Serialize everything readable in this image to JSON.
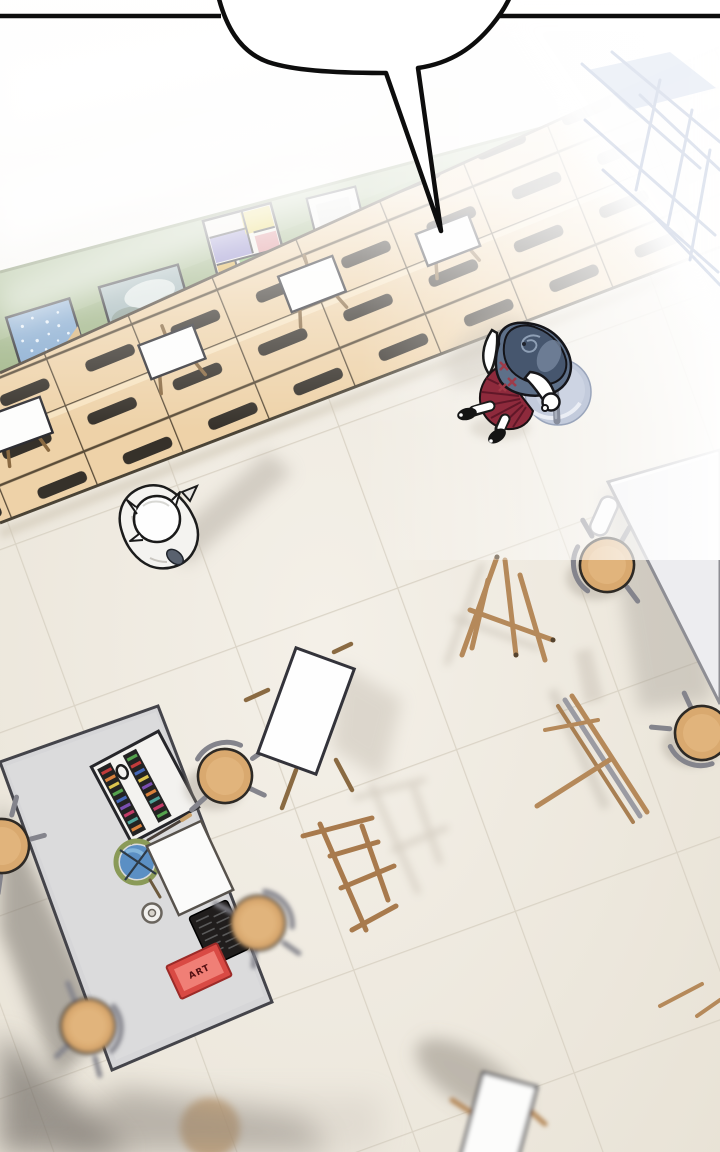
{
  "panel": {
    "type": "webtoon comic panel, overhead view of an art classroom",
    "speech_bubble": {
      "text": "",
      "shape": "white speech bubble cropped by top edge, long narrow tail pointing down toward a canvas on the shelves"
    },
    "sign": {
      "label": "ART"
    },
    "board": {
      "color": "#a6ba8e",
      "artworks": [
        "speckled-blue-painting",
        "blurry-landscape-painting",
        "abstract-color-block-painting",
        "blank-canvas"
      ]
    },
    "shelves": {
      "type": "wooden cubby drawer units with dark slots, white canvases leaning on top",
      "color": "#eed2a8"
    },
    "characters": [
      {
        "name": "student-dark-hair",
        "hair_color": "#46566e",
        "top_color": "#5e7089",
        "plaid_color": "#a23a47",
        "skirt_color": "#8e2a3c",
        "carrying": "round light-blue canvas bag"
      },
      {
        "name": "student-white-hair",
        "hair_color": "#fefefe",
        "outfit_color": "#f4f3f0"
      }
    ],
    "furniture": {
      "teacher_desk_items": [
        "paint-set-box",
        "paintbrush",
        "blue-round-palette",
        "paper-sheet",
        "tape-roll",
        "black-brush-case",
        "red-art-sign"
      ],
      "stool_count": 7,
      "easels": [
        "standing-easel-with-canvas",
        "fallen-folded-easel",
        "leaning-folded-easel",
        "bare-easel-frame",
        "bottom-easel-with-canvas"
      ],
      "tables": [
        "teacher-desk",
        "white-work-table"
      ]
    },
    "palette": {
      "floor": "#ece7dd",
      "board_green": "#a6ba8e",
      "cubby_tan": "#eed2a8",
      "skirt_red": "#8e2a3c",
      "stool_seat": "#d9a96f",
      "bag_blue": "#c3cbdc"
    }
  }
}
